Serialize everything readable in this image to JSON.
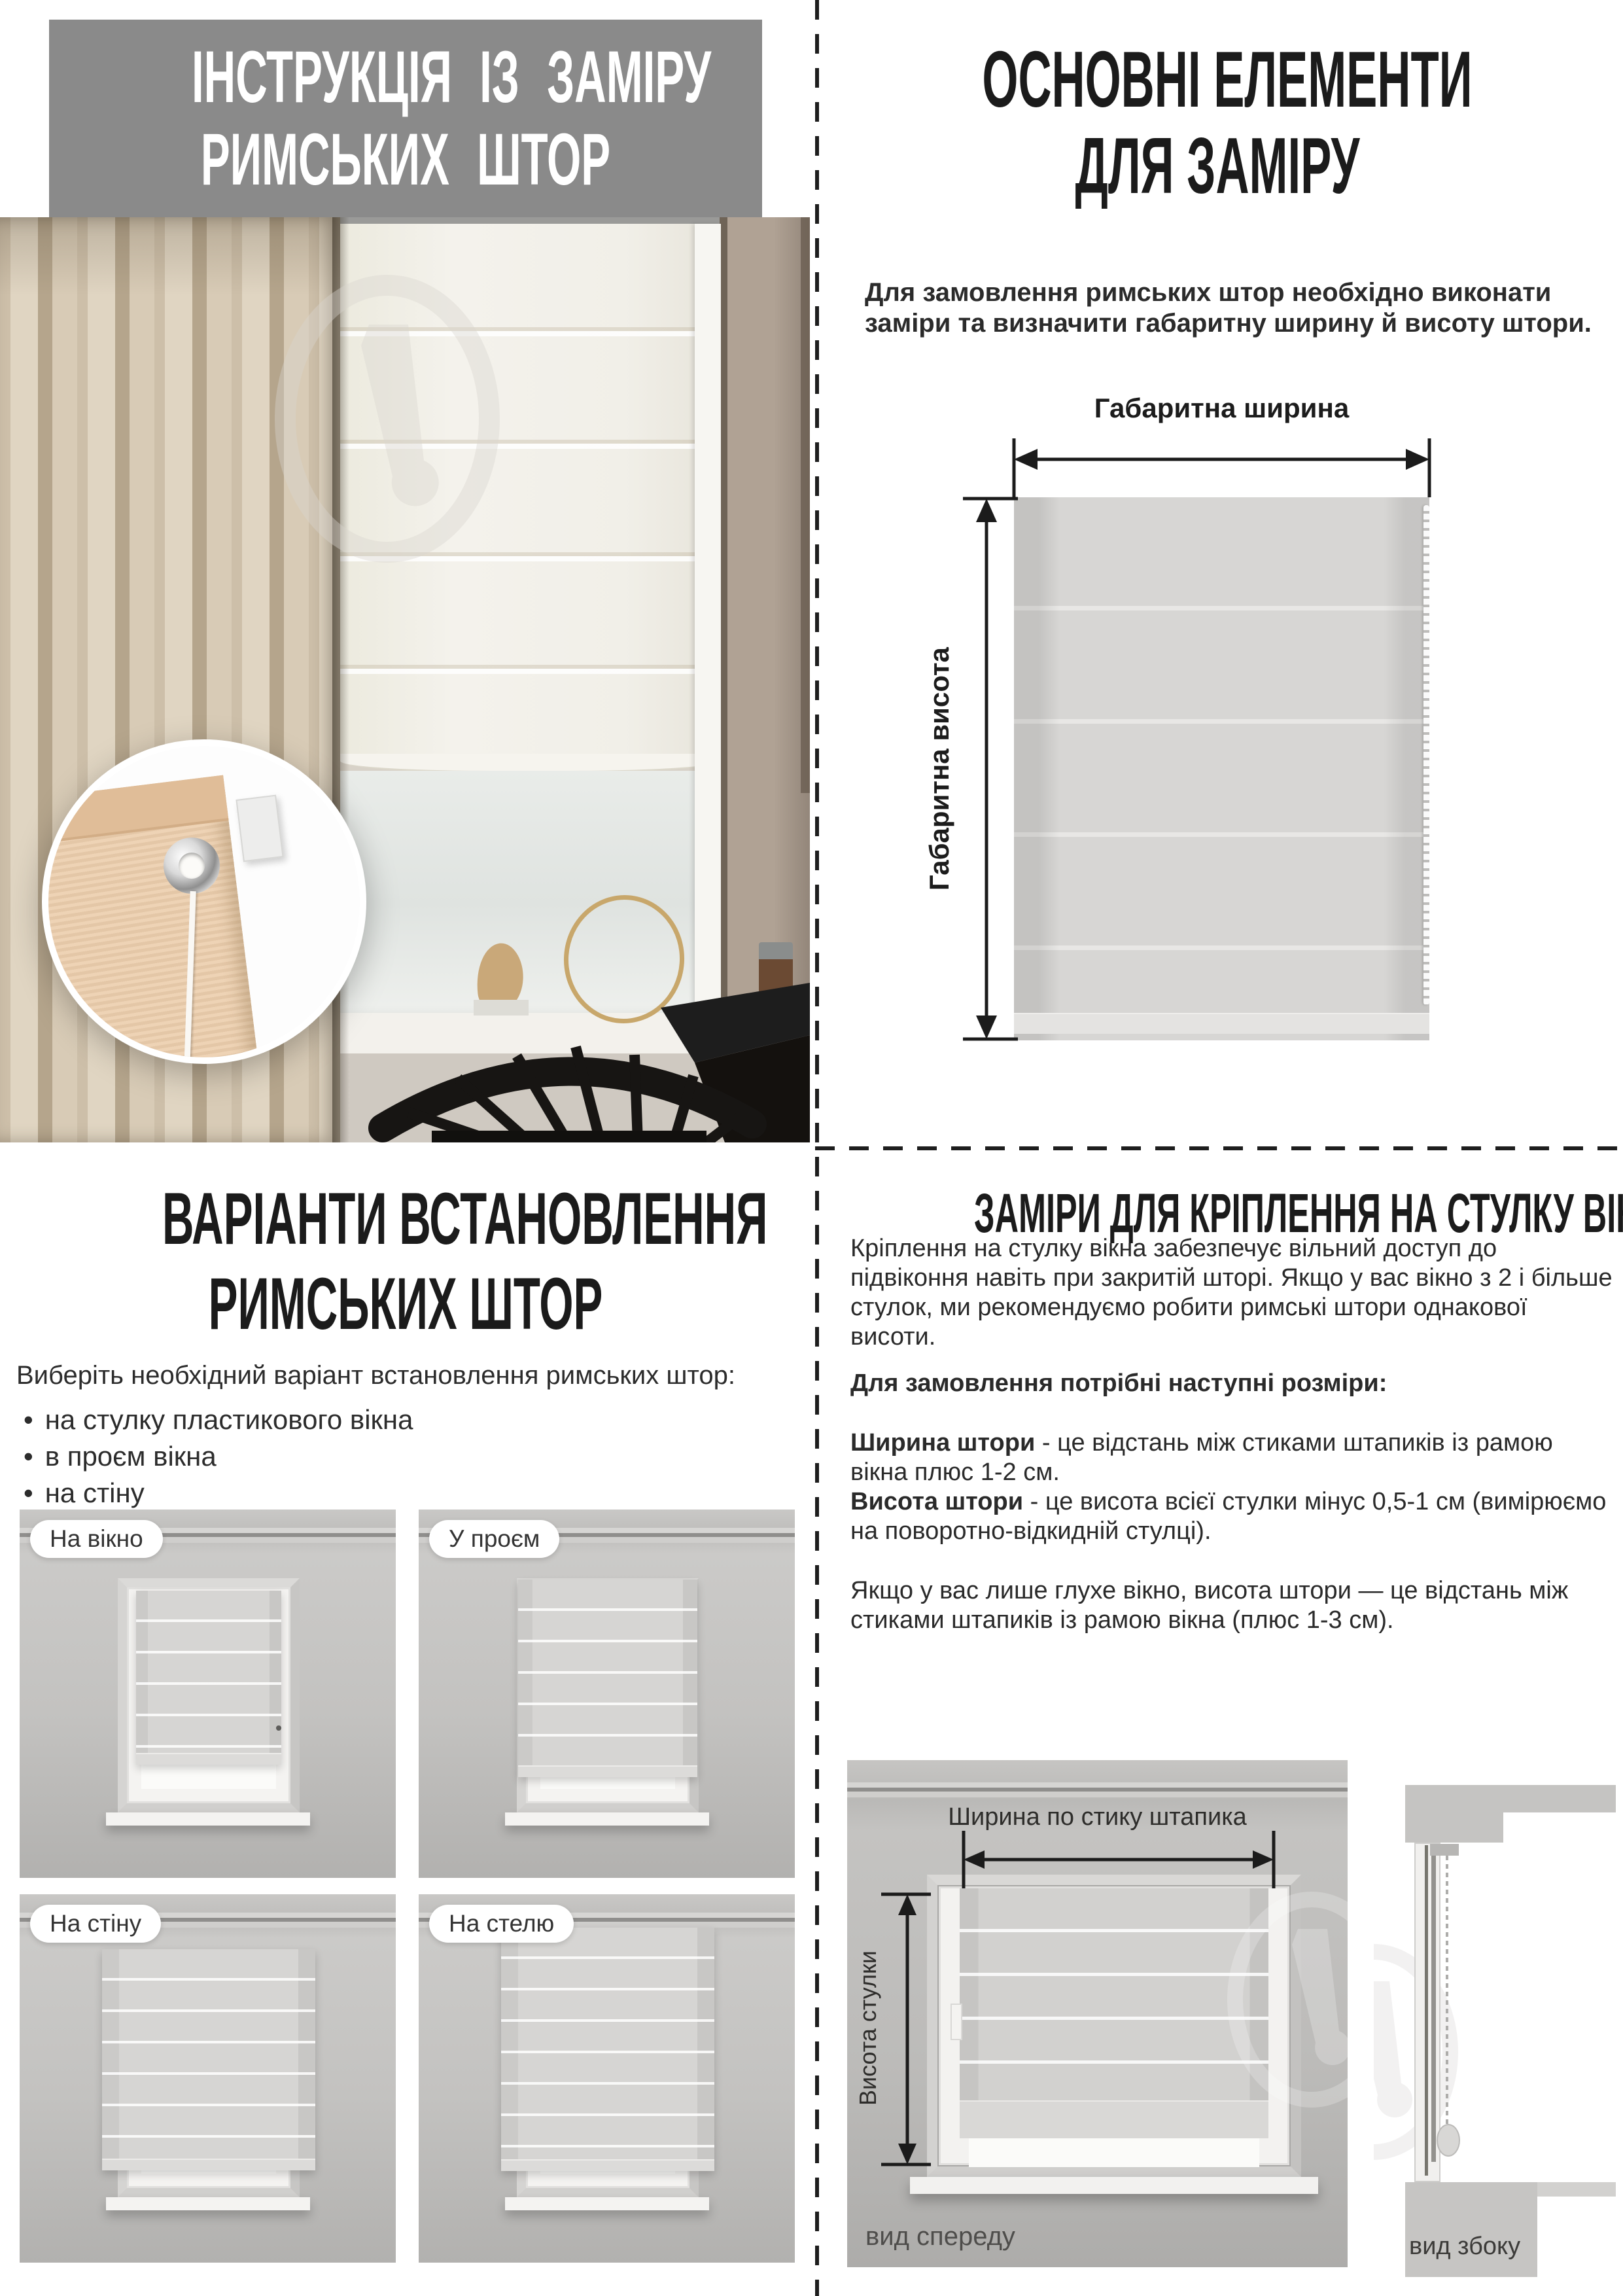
{
  "colors": {
    "title_box_bg": "#8a8a8a",
    "heading_text": "#1b1b1b",
    "body_text": "#2a2a2a",
    "wall_gray": "#bcbbb9",
    "blind_gray": "#d5d4d2",
    "curtain_beige": "#d5c7b0"
  },
  "top_left": {
    "title_line1": "ІНСТРУКЦІЯ ІЗ ЗАМІРУ",
    "title_line2": "РИМСЬКИХ ШТОР"
  },
  "top_right": {
    "heading_line1": "ОСНОВНІ ЕЛЕМЕНТИ",
    "heading_line2": "ДЛЯ ЗАМІРУ",
    "intro": "Для замовлення римських штор необхідно виконати заміри та визначити габаритну ширину й висоту штори.",
    "diagram": {
      "width_label": "Габаритна ширина",
      "height_label": "Габаритна висота"
    }
  },
  "bottom_left": {
    "heading_line1": "ВАРІАНТИ ВСТАНОВЛЕННЯ",
    "heading_line2": "РИМСЬКИХ ШТОР",
    "subtitle": "Виберіть необхідний варіант встановлення римських штор:",
    "options": [
      "на стулку пластикового вікна",
      "в проєм вікна",
      "на стіну",
      "на стелю"
    ],
    "variants": [
      {
        "label": "На вікно"
      },
      {
        "label": "У проєм"
      },
      {
        "label": "На стіну"
      },
      {
        "label": "На стелю"
      }
    ]
  },
  "bottom_right": {
    "heading": "ЗАМІРИ ДЛЯ КРІПЛЕННЯ НА СТУЛКУ ВІКНА",
    "intro": "Кріплення на стулку вікна забезпечує вільний доступ до підвіконня навіть при закритій шторі. Якщо у вас вікно з 2 і більше стулок, ми рекомендуємо робити римські штори однакової висоти.",
    "sizes_heading": "Для замовлення потрібні наступні розміри:",
    "width_term": "Ширина штори",
    "width_def": "- це відстань між стиками штапиків із рамою вікна плюс 1-2 см.",
    "height_term": "Висота штори",
    "height_def": "- це висота всієї стулки мінус 0,5-1 см (вимірюємо на поворотно-відкидній стулці).",
    "note": "Якщо у вас лише глухе вікно, висота штори — це відстань між стиками штапиків із рамою вікна (плюс 1-3 см).",
    "front_view": {
      "width_label": "Ширина по стику штапика",
      "height_label": "Висота стулки",
      "caption": "вид спереду"
    },
    "side_view": {
      "caption": "вид збоку"
    }
  }
}
